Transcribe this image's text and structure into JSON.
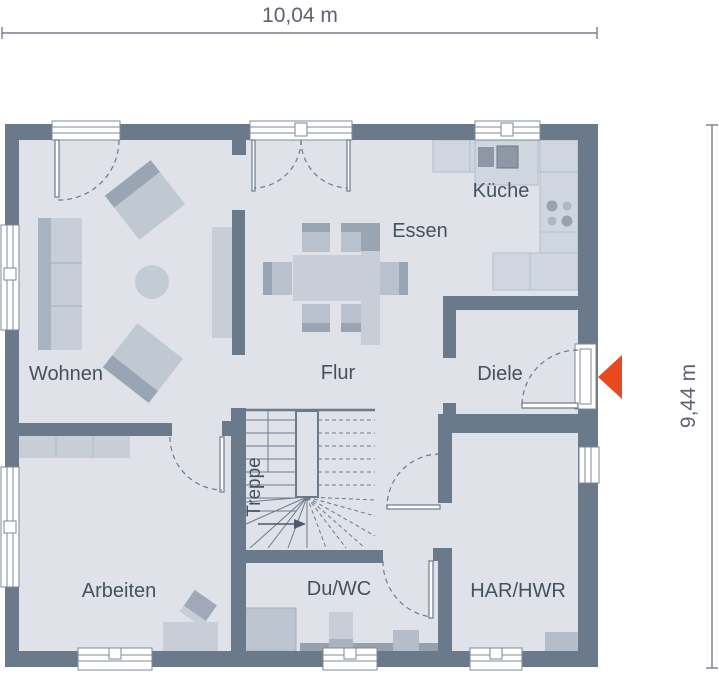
{
  "dimensions": {
    "width": "10,04 m",
    "height": "9,44 m"
  },
  "rooms": [
    {
      "id": "wohnen",
      "label": "Wohnen"
    },
    {
      "id": "essen",
      "label": "Essen"
    },
    {
      "id": "kueche",
      "label": "Küche"
    },
    {
      "id": "flur",
      "label": "Flur"
    },
    {
      "id": "diele",
      "label": "Diele"
    },
    {
      "id": "treppe",
      "label": "Treppe"
    },
    {
      "id": "arbeiten",
      "label": "Arbeiten"
    },
    {
      "id": "duwc",
      "label": "Du/WC"
    },
    {
      "id": "harhwr",
      "label": "HAR/HWR"
    }
  ],
  "entrance": {
    "marker": "left-pointing-triangle"
  },
  "colors": {
    "wall": "#6b7a8a",
    "floor": "#dfe3e9",
    "furniture_light": "#c7ced8",
    "furniture_medium": "#b4bdc9",
    "furniture_dark": "#9aa5b3",
    "counter": "#cfd6df",
    "text": "#46515f",
    "entrance_arrow": "#e84a1e"
  }
}
